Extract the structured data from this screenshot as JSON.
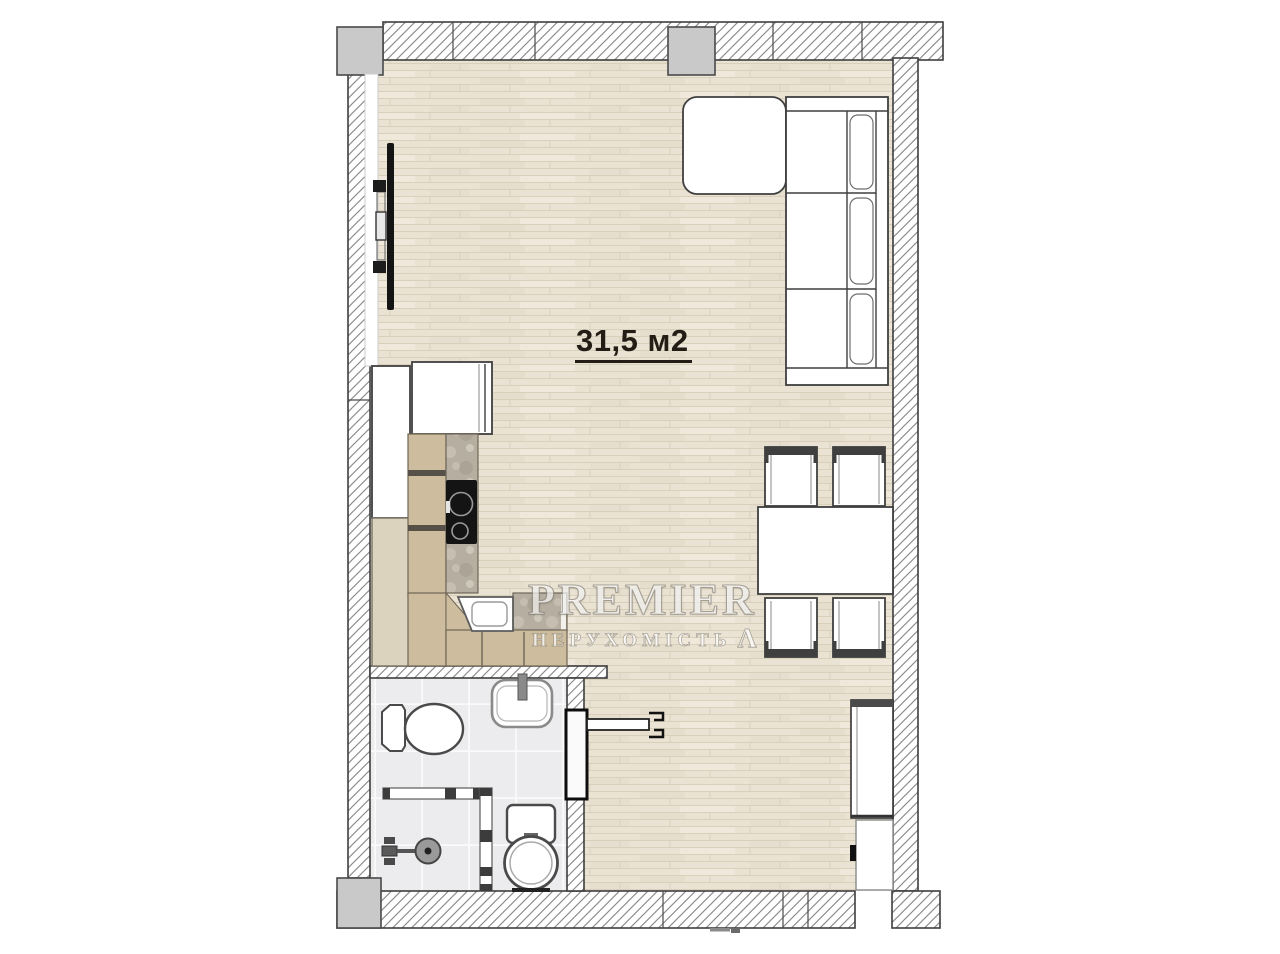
{
  "floorplan": {
    "area_label": "31,5 м2",
    "watermark": {
      "brand": "PREMIER",
      "tagline": "НЕРУХОМІСТЬ",
      "glyph": "Λ"
    },
    "colors": {
      "wall_line": "#3e3e3e",
      "hatch_line": "#8e8e8e",
      "column_fill": "#c9c9c9",
      "floor_wood": "#eae3d4",
      "floor_wood_line": "#d9d0bc",
      "tile_fill": "#ececee",
      "tile_line": "#fafafb",
      "stone_fill": "#b6aea0",
      "cabinet_wood": "#cdbd9e",
      "cabinet_wood_light": "#dcd3bf",
      "furniture_line": "#3f3f3f",
      "appliance_dark": "#141414",
      "label_color": "#241d15",
      "watermark_color": "#ffffff"
    }
  }
}
